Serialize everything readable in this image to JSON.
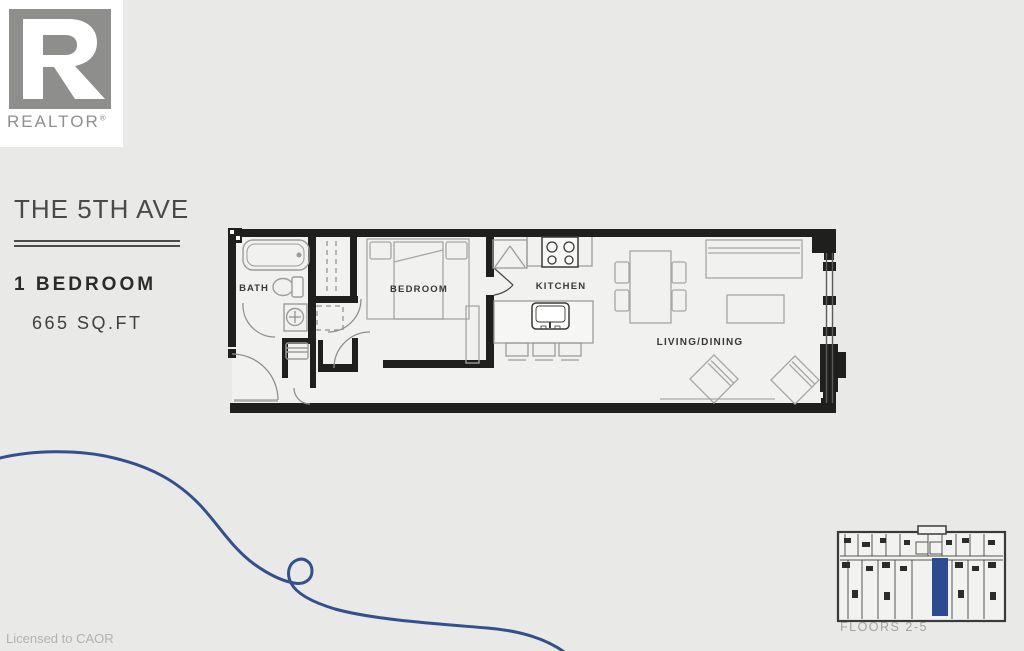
{
  "page": {
    "background": "#e9e9e7",
    "license_text": "Licensed to CAOR"
  },
  "branding": {
    "logo_text": "REALTOR",
    "registered_mark": "®"
  },
  "listing": {
    "building_name": "THE 5TH AVE",
    "unit_type": "1 BEDROOM",
    "area": "665 SQ.FT"
  },
  "floor_plan": {
    "labels": {
      "bath": "BATH",
      "bedroom": "BEDROOM",
      "kitchen": "KITCHEN",
      "living_dining": "LIVING/DINING"
    }
  },
  "key_plan": {
    "caption": "FLOORS 2-5",
    "highlight_color": "#2d4b8e"
  },
  "colors": {
    "background": "#e9e9e7",
    "floor": "#f1f1ef",
    "wall": "#1f1f1d",
    "fixture": "#9c9c9a",
    "accent_blue": "#34508c"
  }
}
